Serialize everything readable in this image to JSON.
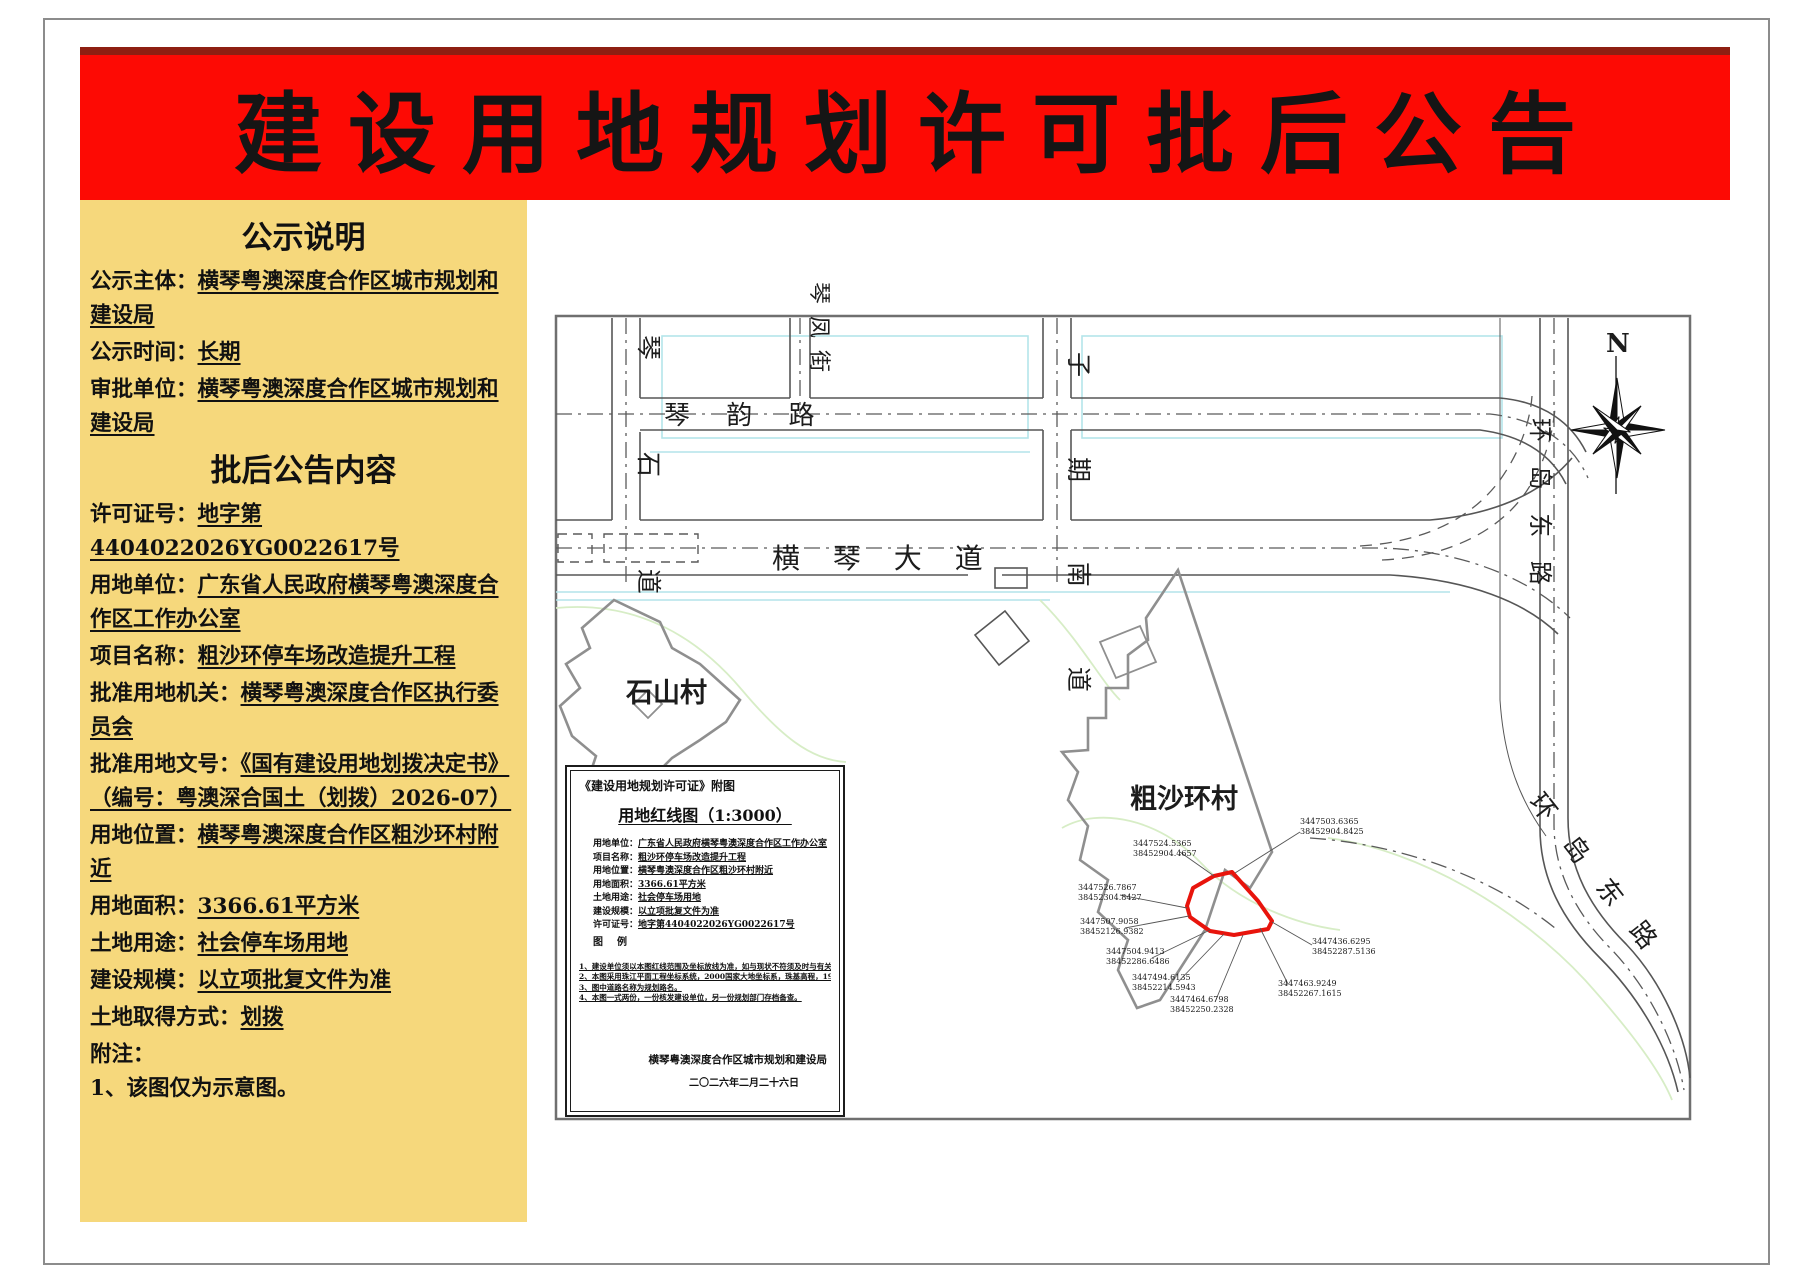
{
  "banner": {
    "title": "建设用地规划许可批后公告"
  },
  "sidebar": {
    "section1_title": "公示说明",
    "items1": [
      {
        "label": "公示主体：",
        "value": "横琴粤澳深度合作区城市规划和建设局"
      },
      {
        "label": "公示时间：",
        "value": "长期"
      },
      {
        "label": "审批单位：",
        "value": "横琴粤澳深度合作区城市规划和建设局"
      }
    ],
    "section2_title": "批后公告内容",
    "items2": [
      {
        "label": "许可证号：",
        "value": "地字第4404022026YG0022617号"
      },
      {
        "label": "用地单位：",
        "value": "广东省人民政府横琴粤澳深度合作区工作办公室"
      },
      {
        "label": "项目名称：",
        "value": "粗沙环停车场改造提升工程"
      },
      {
        "label": "批准用地机关：",
        "value": "横琴粤澳深度合作区执行委员会"
      },
      {
        "label": "批准用地文号：",
        "value": "《国有建设用地划拨决定书》（编号：粤澳深合国土（划拨）2026-07）"
      },
      {
        "label": "用地位置：",
        "value": "横琴粤澳深度合作区粗沙环村附近"
      },
      {
        "label": "用地面积：",
        "value": "3366.61平方米"
      },
      {
        "label": "土地用途：",
        "value": "社会停车场用地"
      },
      {
        "label": "建设规模：",
        "value": "以立项批复文件为准"
      },
      {
        "label": "土地取得方式：",
        "value": "划拨"
      }
    ],
    "notes_label": "附注：",
    "notes": [
      "1、该图仅为示意图。"
    ]
  },
  "map": {
    "road_labels": {
      "qinshidao": "琴 石 道",
      "qinyunlu": "琴 韵 路",
      "qinfengjie": "琴凤街",
      "ziqinandao": "子 期 南 道",
      "hengqindadao": "横 琴 大 道",
      "huandaodonglu": "环 岛 东 路"
    },
    "village_labels": {
      "shishancun": "石山村",
      "cushahuancun": "粗沙环村"
    },
    "compass_label": "N",
    "parcel": {
      "color": "#e8140c",
      "vertex_labels": [
        {
          "l1": "3447524.5365",
          "l2": "38452904.4657"
        },
        {
          "l1": "3447503.6365",
          "l2": "38452904.8425"
        },
        {
          "l1": "3447526.7867",
          "l2": "38452304.8427"
        },
        {
          "l1": "3447507.9058",
          "l2": "38452126.9382"
        },
        {
          "l1": "3447504.9413",
          "l2": "38452286.6486"
        },
        {
          "l1": "3447494.6135",
          "l2": "38452214.5943"
        },
        {
          "l1": "3447464.6798",
          "l2": "38452250.2328"
        },
        {
          "l1": "3447463.9249",
          "l2": "38452267.1615"
        },
        {
          "l1": "3447436.6295",
          "l2": "38452287.5136"
        }
      ]
    },
    "inset": {
      "header": "《建设用地规划许可证》附图",
      "title": "用地红线图（1:3000）",
      "fields": [
        {
          "label": "用地单位：",
          "value": "广东省人民政府横琴粤澳深度合作区工作办公室"
        },
        {
          "label": "项目名称：",
          "value": "粗沙环停车场改造提升工程"
        },
        {
          "label": "用地位置：",
          "value": "横琴粤澳深度合作区粗沙环村附近"
        },
        {
          "label": "用地面积：",
          "value": "3366.61平方米"
        },
        {
          "label": "土地用途：",
          "value": "社会停车场用地"
        },
        {
          "label": "建设规模：",
          "value": "以立项批复文件为准"
        },
        {
          "label": "许可证号：",
          "value": "地字第4404022026YG0022617号"
        }
      ],
      "legend_label": "图例",
      "notes": [
        "1、建设单位须以本图红线范围及坐标放线为准，如与现状不符须及时与有关日常管理部门确认。",
        "2、本图采用珠江平面工程坐标系统，2000国家大地坐标系，珠基高程，1985年国家高程基准，数据单位为米。",
        "3、图中道路名称为规划路名。",
        "4、本图一式两份，一份核发建设单位，另一份规划部门存档备查。"
      ],
      "agency": "横琴粤澳深度合作区城市规划和建设局",
      "date": "二〇二六年二月二十六日"
    }
  }
}
